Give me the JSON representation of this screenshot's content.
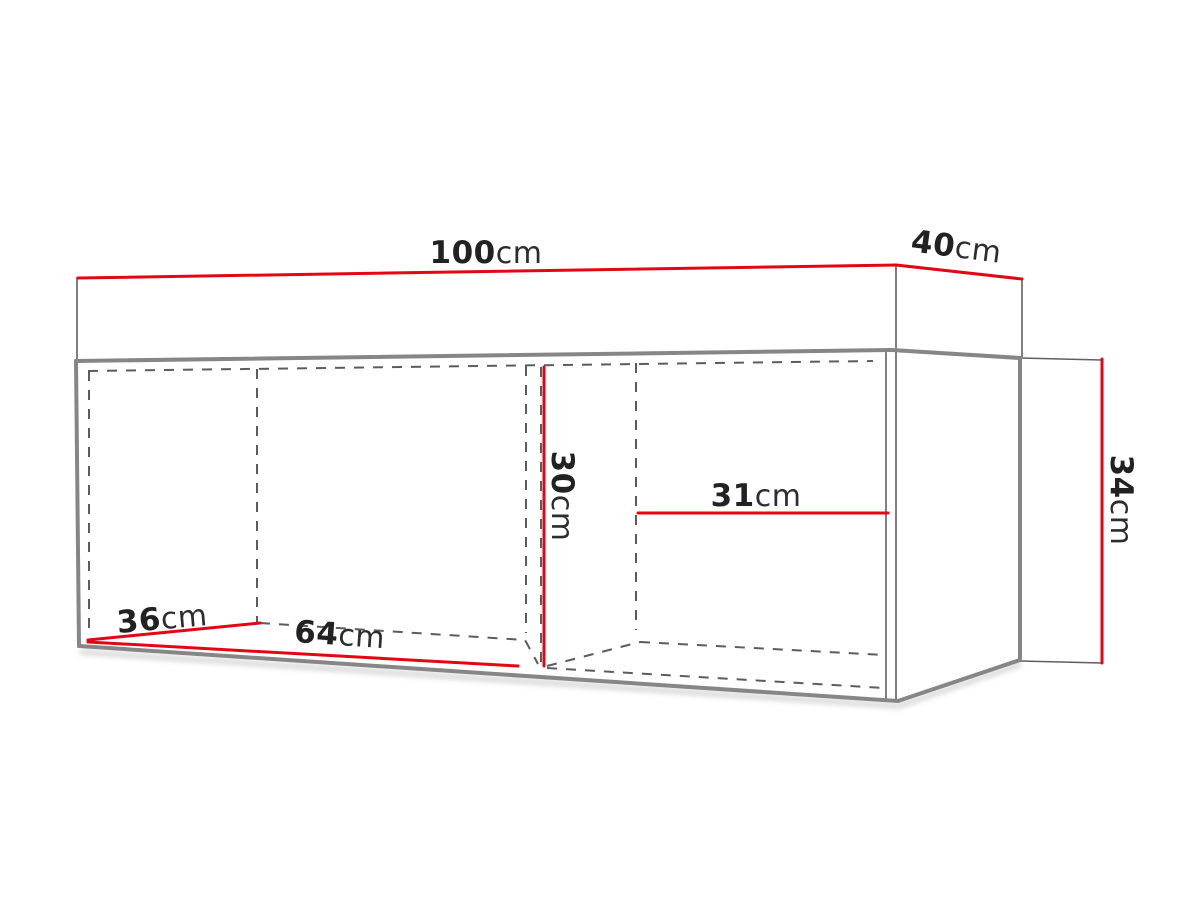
{
  "diagram": {
    "type": "furniture-dimension-drawing",
    "subject": "wall-mounted cabinet, 3D outline with dashed interior lines",
    "unit": "cm",
    "dimensions": [
      {
        "id": "total-width",
        "value": "100",
        "unit": "cm",
        "location": "top edge, front"
      },
      {
        "id": "depth",
        "value": "40",
        "unit": "cm",
        "location": "top edge, right side"
      },
      {
        "id": "height",
        "value": "34",
        "unit": "cm",
        "location": "right side, vertical (rotated label)"
      },
      {
        "id": "interior-height",
        "value": "30",
        "unit": "cm",
        "location": "inside at middle divider, vertical (rotated label)"
      },
      {
        "id": "right-compartment-width",
        "value": "31",
        "unit": "cm",
        "location": "inside right compartment, horizontal"
      },
      {
        "id": "interior-depth",
        "value": "36",
        "unit": "cm",
        "location": "bottom left, diagonal depth line"
      },
      {
        "id": "left-compartment-width",
        "value": "64",
        "unit": "cm",
        "location": "bottom front edge, left section"
      }
    ],
    "colors": {
      "dimension-line": "#e30613",
      "cabinet-edge-thick": "#868686",
      "cabinet-edge-thin": "#5f5f5f",
      "hidden-line-dashed": "#5c5c5c",
      "label-text": "#222222",
      "background": "#ffffff"
    }
  }
}
